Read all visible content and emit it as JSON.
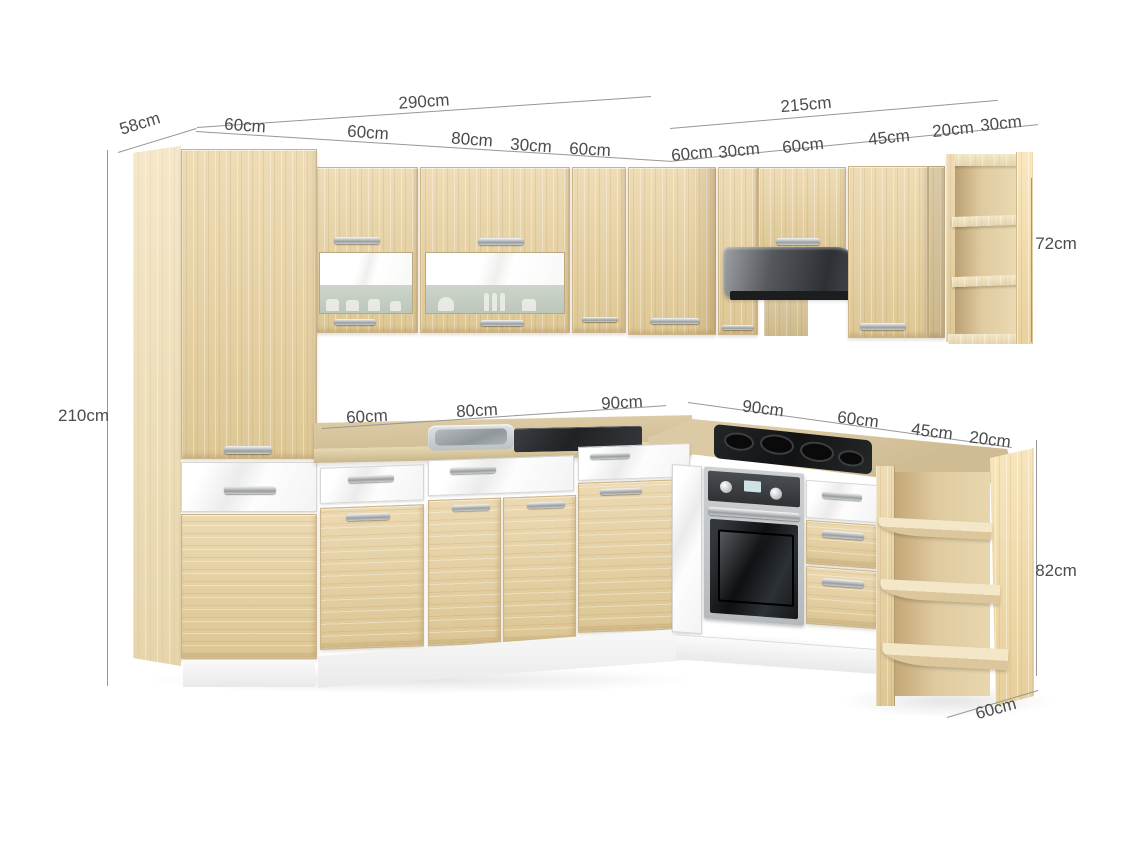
{
  "title": "L-shaped kitchen cabinet set — dimension diagram",
  "dims": {
    "total_left": "290cm",
    "total_right": "215cm",
    "depth_tall": "58cm",
    "height_tall": "210cm",
    "height_wall": "72cm",
    "height_base": "82cm",
    "depth_end": "60cm",
    "top_left": [
      "60cm",
      "60cm",
      "80cm",
      "30cm",
      "60cm"
    ],
    "top_right": [
      "60cm",
      "30cm",
      "60cm",
      "45cm",
      "20cm",
      "30cm"
    ],
    "mid_left": [
      "60cm",
      "80cm",
      "90cm"
    ],
    "mid_right": [
      "90cm",
      "60cm",
      "45cm",
      "20cm"
    ]
  },
  "colors": {
    "wood": "#e6d2a6",
    "wood_light": "#f0e2c1",
    "countertop": "#d7c59e",
    "front_white": "#fafafa",
    "steel": "#c3c7c9",
    "appliance_dark": "#232527",
    "dim_line": "#979797",
    "dim_text": "#4c4c4c",
    "background": "#ffffff"
  }
}
